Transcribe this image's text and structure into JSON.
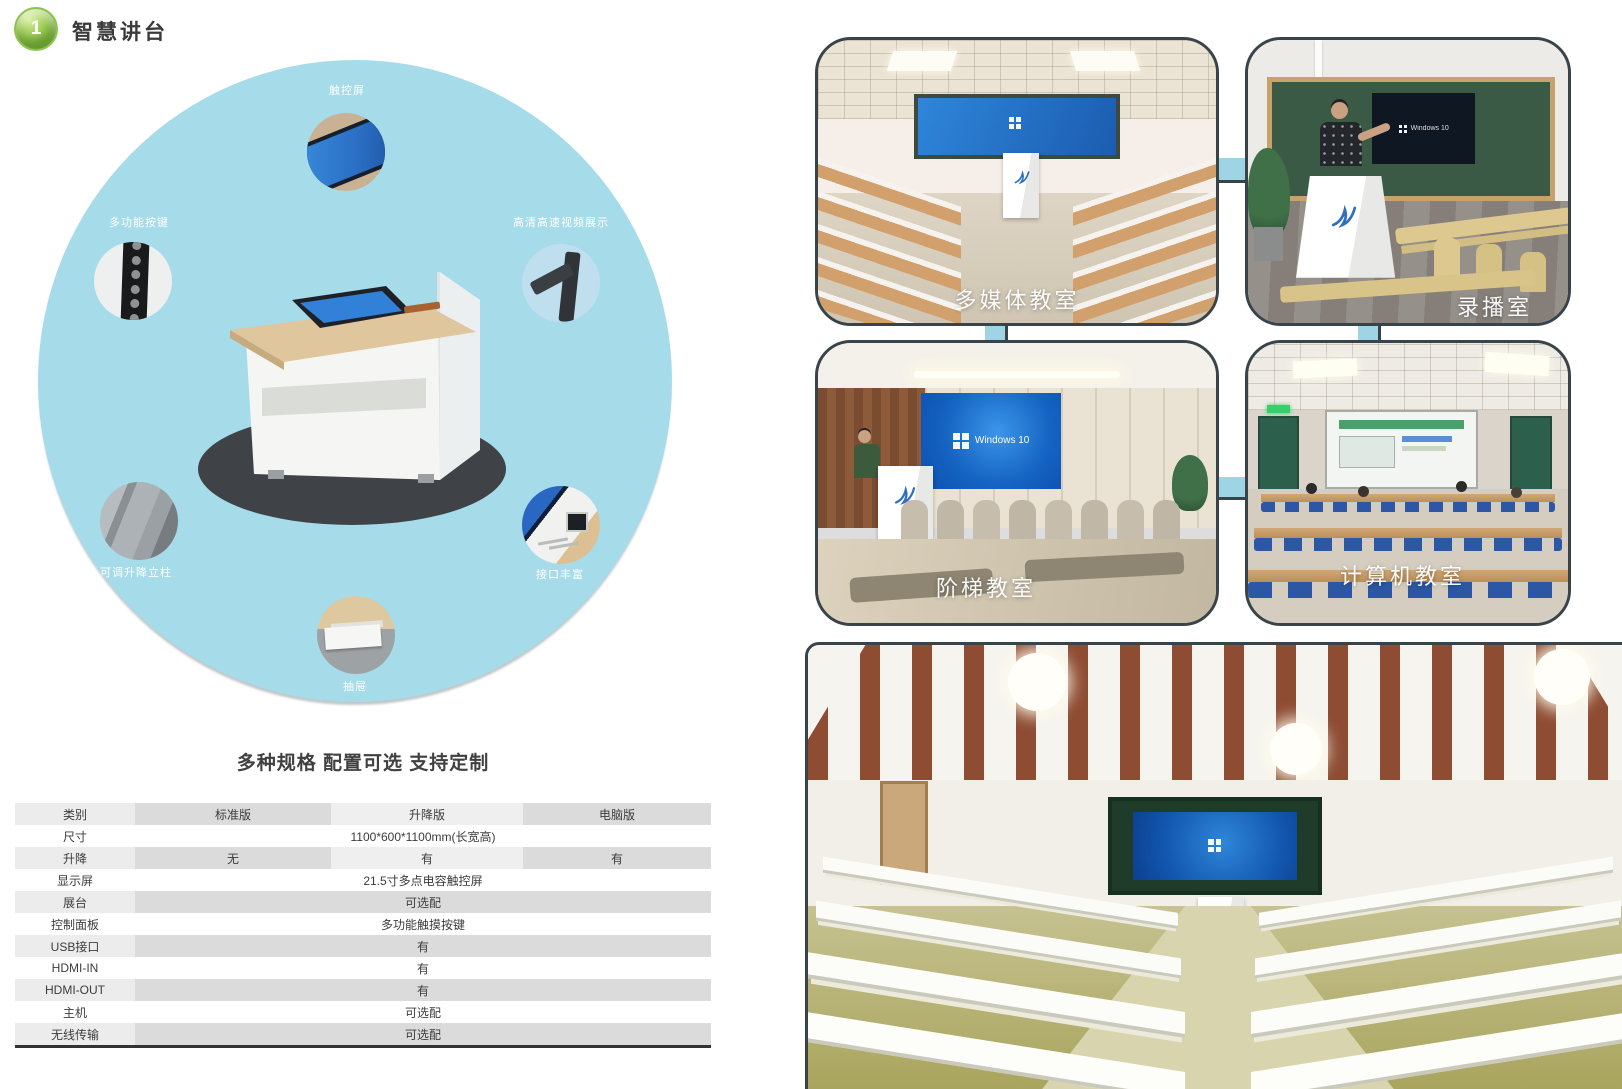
{
  "header": {
    "badge": "1",
    "title": "智慧讲台"
  },
  "features": {
    "touch_screen": "触控屏",
    "multi_function_buttons": "多功能按键",
    "hd_video_display": "高清高速视频展示",
    "adjustable_column": "可调升降立柱",
    "rich_ports": "接口丰富",
    "drawer": "抽屉"
  },
  "spec": {
    "heading": "多种规格 配置可选 支持定制",
    "columns": [
      "类别",
      "标准版",
      "升降版",
      "电脑版"
    ],
    "rows": [
      {
        "label": "尺寸",
        "value": "1100*600*1100mm(长宽高)"
      },
      {
        "label": "升降",
        "values": [
          "无",
          "有",
          "有"
        ]
      },
      {
        "label": "显示屏",
        "value": "21.5寸多点电容触控屏"
      },
      {
        "label": "展台",
        "value": "可选配"
      },
      {
        "label": "控制面板",
        "value": "多功能触摸按键"
      },
      {
        "label": "USB接口",
        "value": "有"
      },
      {
        "label": "HDMI-IN",
        "value": "有"
      },
      {
        "label": "HDMI-OUT",
        "value": "有"
      },
      {
        "label": "主机",
        "value": "可选配"
      },
      {
        "label": "无线传输",
        "value": "可选配"
      }
    ]
  },
  "gallery": {
    "multimedia": {
      "label": "多媒体教室"
    },
    "recording": {
      "label": "录播室",
      "screen_text": "Windows 10"
    },
    "lecture_hall": {
      "label": "阶梯教室",
      "screen_text": "Windows 10"
    },
    "computer": {
      "label": "计算机教室"
    }
  },
  "colors": {
    "accent_blue": "#a6dbea",
    "badge_green": "#7cb23a",
    "photo_border": "#39444a",
    "board_green": "#2f4a38"
  }
}
